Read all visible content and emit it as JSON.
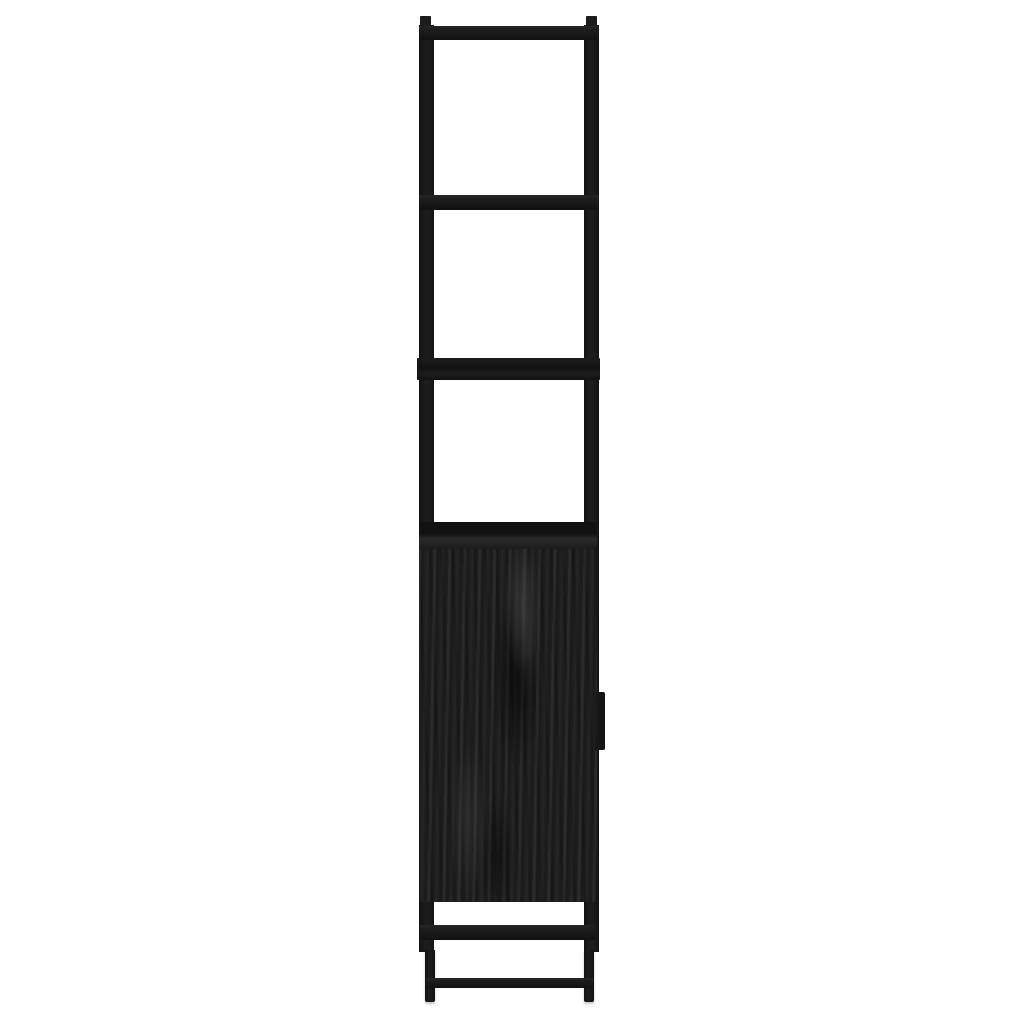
{
  "scene": {
    "type": "product-photo",
    "subject": "Tall narrow black bathroom storage cabinet, side profile view",
    "background": "plain white studio background",
    "orientation": "vertical, centered horizontally"
  },
  "colors": {
    "background": "#ffffff",
    "frame": "#1c1c1c",
    "frame_dark": "#121212",
    "frame_light": "#262626",
    "panel_base": "#1f1f1f",
    "grain_light": "#2f2f2f",
    "grain_dark": "#121212",
    "handle": "#1a1a1a"
  },
  "parts": {
    "peg_left": "left top mounting peg",
    "peg_right": "right top mounting peg",
    "post_left": "rear vertical frame post",
    "post_right": "front vertical frame post",
    "rail_top": "top frame rail (edge-on)",
    "rail_upper": "upper shelf edge (edge-on)",
    "shelf_mid": "middle wooden shelf edge (edge-on)",
    "cabinet_body": "cabinet box side panel, black wood grain",
    "cabinet_top_band": "cabinet top board edge",
    "door_handle": "cabinet door handle protruding at front",
    "rail_under_cabinet": "frame rail below cabinet box",
    "rail_bottom": "bottom foot rail",
    "leg_left": "rear leg",
    "leg_right": "front leg"
  }
}
